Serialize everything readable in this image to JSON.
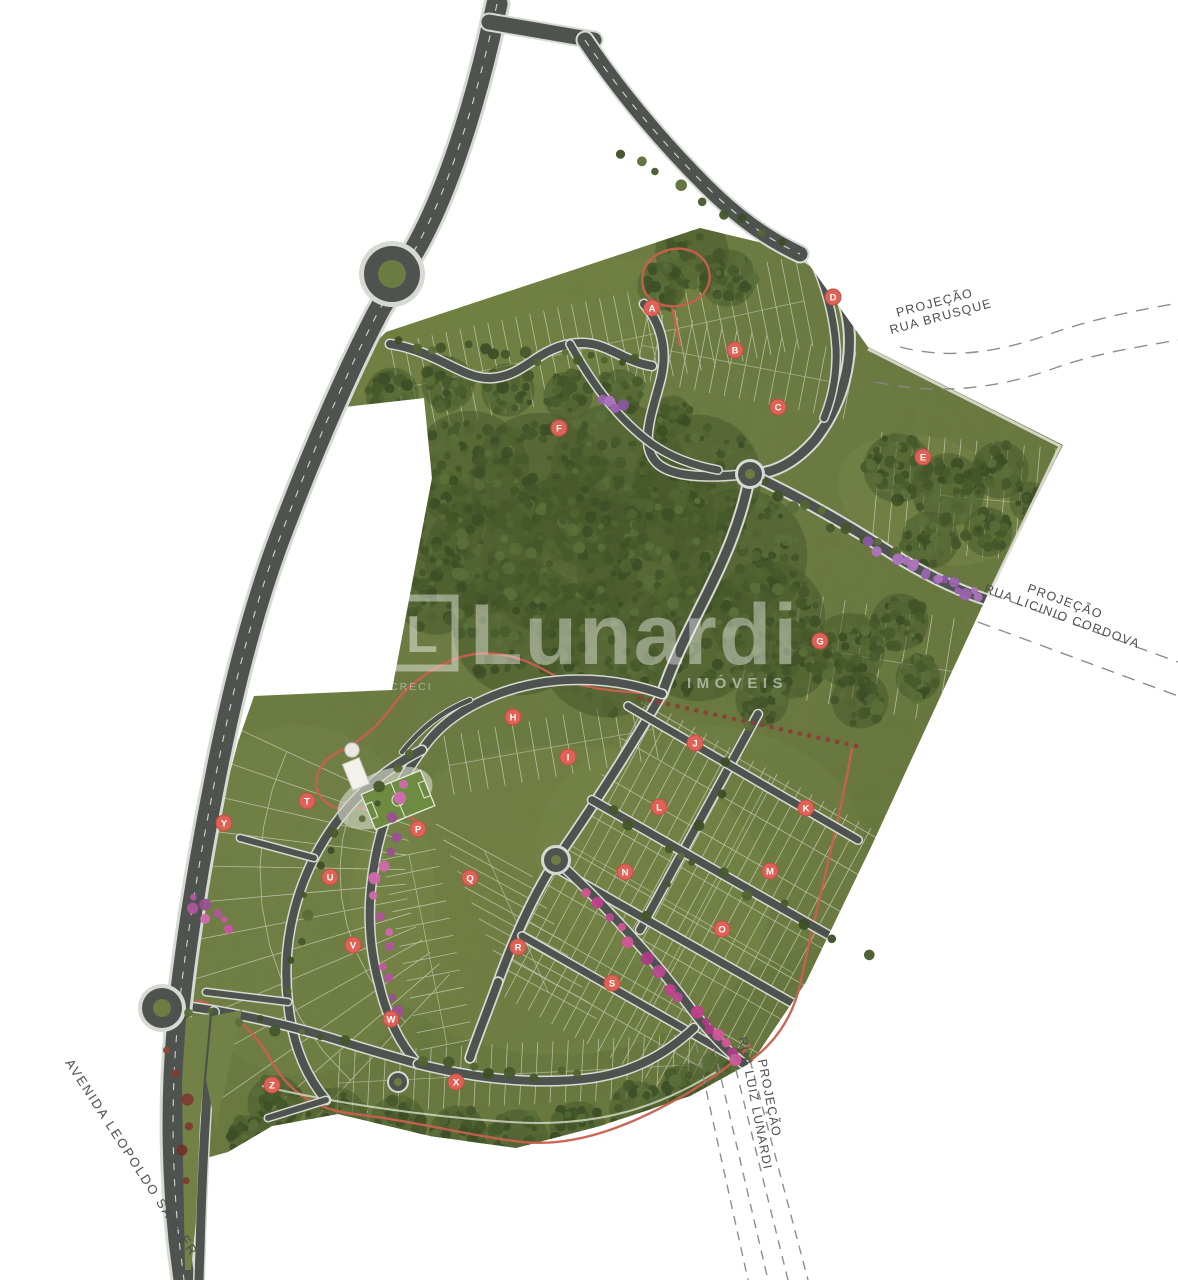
{
  "map": {
    "watermark": {
      "logo_letter": "L",
      "brand": "Lunardi",
      "tagline": "IMÓVEIS",
      "creci": "CRECI"
    },
    "streets": {
      "avenue": "AVENIDA LEOPOLDO SANDER",
      "brusque": {
        "line1": "PROJEÇÃO",
        "line2": "RUA BRUSQUE"
      },
      "licinio": {
        "line1": "PROJEÇÃO",
        "line2": "RUA  LICINIO CORDOVA"
      },
      "luiz_lunardi": {
        "line1": "PROJEÇÃO",
        "line2": "RUA LUIZ LUNARDI"
      }
    },
    "blocks": [
      {
        "letter": "A",
        "x": 652,
        "y": 308
      },
      {
        "letter": "B",
        "x": 735,
        "y": 350
      },
      {
        "letter": "C",
        "x": 778,
        "y": 407
      },
      {
        "letter": "D",
        "x": 833,
        "y": 297
      },
      {
        "letter": "E",
        "x": 923,
        "y": 457
      },
      {
        "letter": "F",
        "x": 559,
        "y": 428
      },
      {
        "letter": "G",
        "x": 820,
        "y": 641
      },
      {
        "letter": "H",
        "x": 513,
        "y": 717
      },
      {
        "letter": "I",
        "x": 568,
        "y": 757
      },
      {
        "letter": "J",
        "x": 695,
        "y": 743
      },
      {
        "letter": "K",
        "x": 806,
        "y": 808
      },
      {
        "letter": "L",
        "x": 659,
        "y": 807
      },
      {
        "letter": "M",
        "x": 770,
        "y": 871
      },
      {
        "letter": "N",
        "x": 625,
        "y": 872
      },
      {
        "letter": "O",
        "x": 722,
        "y": 929
      },
      {
        "letter": "P",
        "x": 418,
        "y": 829
      },
      {
        "letter": "Q",
        "x": 470,
        "y": 878
      },
      {
        "letter": "R",
        "x": 518,
        "y": 947
      },
      {
        "letter": "S",
        "x": 612,
        "y": 983
      },
      {
        "letter": "T",
        "x": 307,
        "y": 801
      },
      {
        "letter": "U",
        "x": 330,
        "y": 877
      },
      {
        "letter": "V",
        "x": 353,
        "y": 945
      },
      {
        "letter": "W",
        "x": 391,
        "y": 1019
      },
      {
        "letter": "X",
        "x": 456,
        "y": 1082
      },
      {
        "letter": "Y",
        "x": 224,
        "y": 823
      },
      {
        "letter": "Z",
        "x": 272,
        "y": 1085
      }
    ],
    "colors": {
      "site_green": "#6b7a41",
      "forest_green": "#49592c",
      "lawn_green": "#82914f",
      "road_gray": "#4e5350",
      "sidewalk_gray": "#d7dad2",
      "marker_red": "#df6257",
      "marker_ring": "#c04f45",
      "trail_red": "#c8604f",
      "flower_purple": "#9a63ad",
      "flower_magenta": "#c2478f",
      "dash_gray": "#888888",
      "label_gray": "#4d4d4d",
      "lot_line": "#ffffff"
    }
  }
}
